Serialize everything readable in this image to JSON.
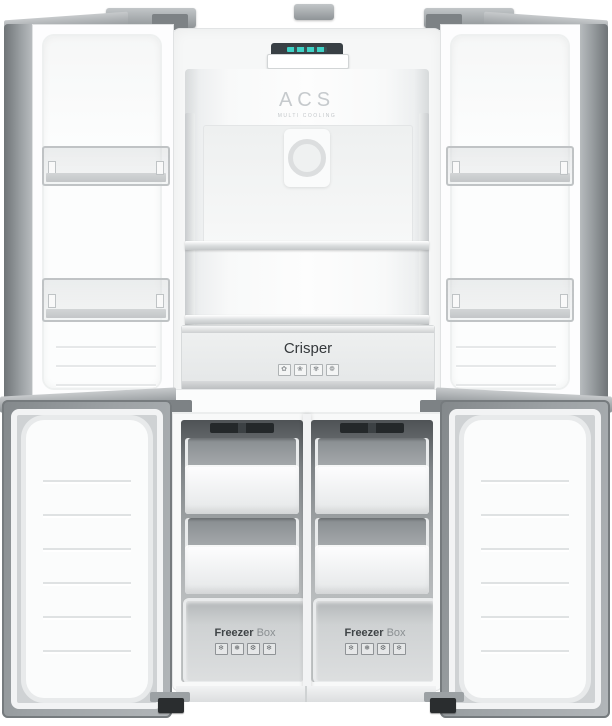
{
  "photo": {
    "subject": "Four-door cross refrigerator with all doors open and empty interior",
    "background": "#ffffff"
  },
  "branding": {
    "logo": "ACS",
    "tagline": "MULTI COOLING"
  },
  "display": {
    "accent_color": "#3ed1c5"
  },
  "crisper": {
    "label": "Crisper",
    "icon_glyphs": [
      "✿",
      "❀",
      "✾",
      "❁"
    ]
  },
  "freezer_box": {
    "label_bold": "Freezer",
    "label_light": "Box",
    "icon_glyphs": [
      "❄",
      "❅",
      "❆",
      "❄"
    ]
  },
  "colors": {
    "door_metal": "#9aa0a3",
    "cavity_dark": "#5a5f62",
    "hinge": "#8f9497",
    "display_teal": "#3ed1c5",
    "label_text": "#3f4447"
  }
}
